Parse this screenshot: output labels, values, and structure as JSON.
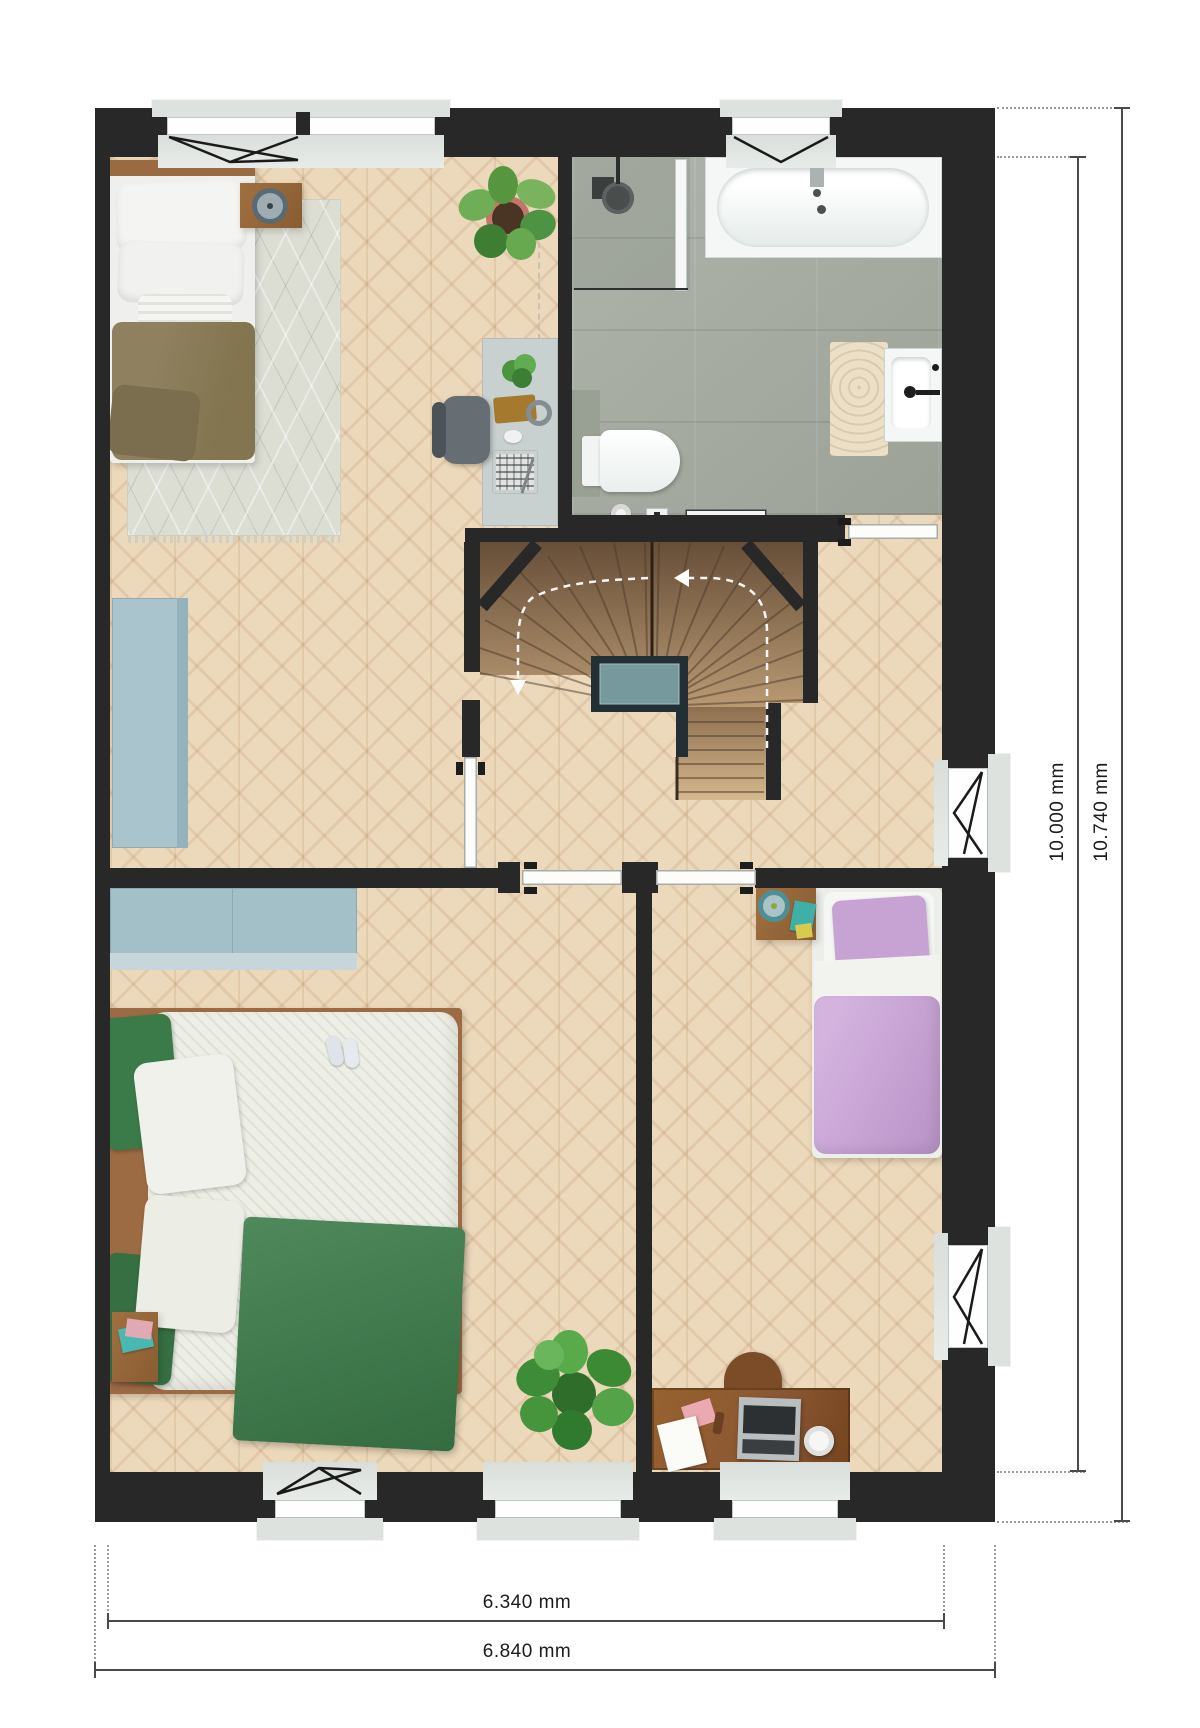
{
  "dimensions": {
    "bottom_inner": "6.340 mm",
    "bottom_outer": "6.840 mm",
    "right_inner": "10.000 mm",
    "right_outer": "10.740 mm"
  },
  "palette": {
    "wall": "#282828",
    "wood_floor": "#ecd8ba",
    "tile_floor": "#a6aca1",
    "stair_dark": "#674e38",
    "stair_light": "#bb9c75",
    "landing_teal": "#76999d",
    "cabinet_blue": "#a9c4cc",
    "rug": "#dcddd3",
    "bed_olive": "#8f8160",
    "bed_green": "#3b7b49",
    "bed_purple": "#c7a3d4",
    "desk_wood": "#8a5632",
    "fixture_white": "#f4f7f6",
    "dim_line": "#4a4a4a",
    "dim_text": "#1c1c1c"
  }
}
